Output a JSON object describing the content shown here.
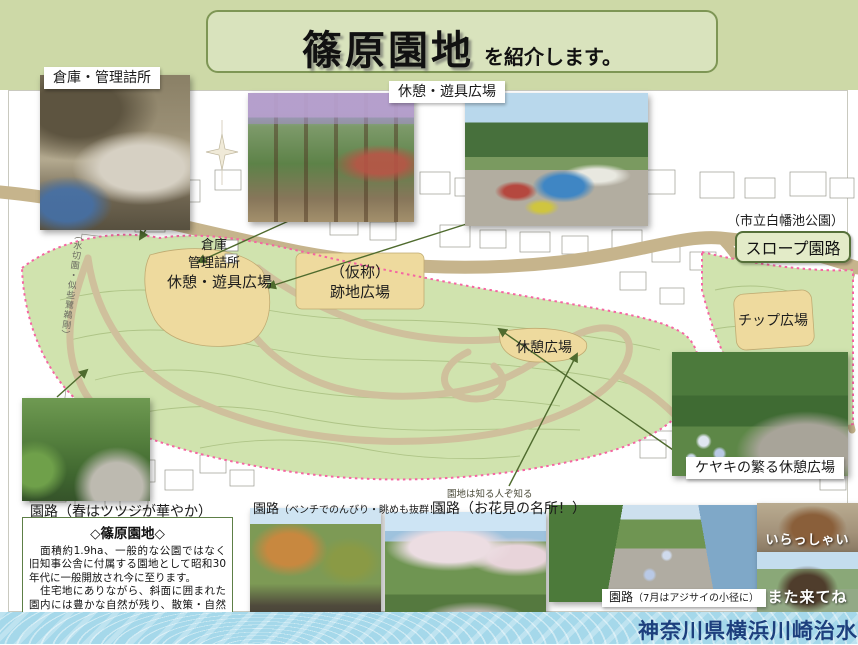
{
  "banner": {
    "title": "篠原園地",
    "suffix": "を紹介します。"
  },
  "photo_labels": {
    "storage": "倉庫・管理詰所",
    "playground": "休憩・遊具広場",
    "keyaki": "ケヤキの繁る休憩広場"
  },
  "map_labels": {
    "storage_l1": "倉庫",
    "storage_l2": "管理詰所",
    "play_plaza": "休憩・遊具広場",
    "kasho_l1": "（仮称）",
    "kasho_l2": "跡地広場",
    "rest_plaza": "休憩広場",
    "chip_plaza": "チップ広場",
    "slope_path": "スロープ園路",
    "shirahata_park": "（市立白幡池公園）",
    "hidden_gem_note": "園地は知る人ぞ知る",
    "left_vertical_text": "（水切園・似些鷺鵜剛）"
  },
  "captions": {
    "spring_path": "園路（春はツツジが華やか）",
    "bench_main": "園路",
    "bench_sub": "（ベンチでのんびり・眺めも抜群！）",
    "hanami": "園路（お花見の名所！）",
    "ajisai_main": "園路",
    "ajisai_sub": "（7月はアジサイの小径に）",
    "squirrel_top": "いらっしゃい",
    "squirrel_bottom": "また来てね"
  },
  "info_box": {
    "title": "◇篠原園地◇",
    "para1": "　面積約1.9ha、一般的な公園ではなく旧知事公舎に付属する園地として昭和30年代に一般開放され今に至ります。",
    "para2": "　住宅地にありながら、斜面に囲まれた園内には豊かな自然が残り、散策・自然観察・お子さんの遊びの場など地域憩いの場として皆様に親しまれています。"
  },
  "footer": {
    "agency": "神奈川県横浜川崎治水事務所"
  },
  "colors": {
    "strip_green": "#cdd9a7",
    "banner_green": "#d9e3bd",
    "map_green": "#d0e3ae",
    "path_tan": "#c6b48c",
    "plaza_tan": "#eeda9e",
    "boundary_pink": "#f565a2",
    "arrow_green": "#4f6b2e",
    "footer_blue": "#a5d8ea",
    "footer_navy": "#1d3f7d"
  }
}
